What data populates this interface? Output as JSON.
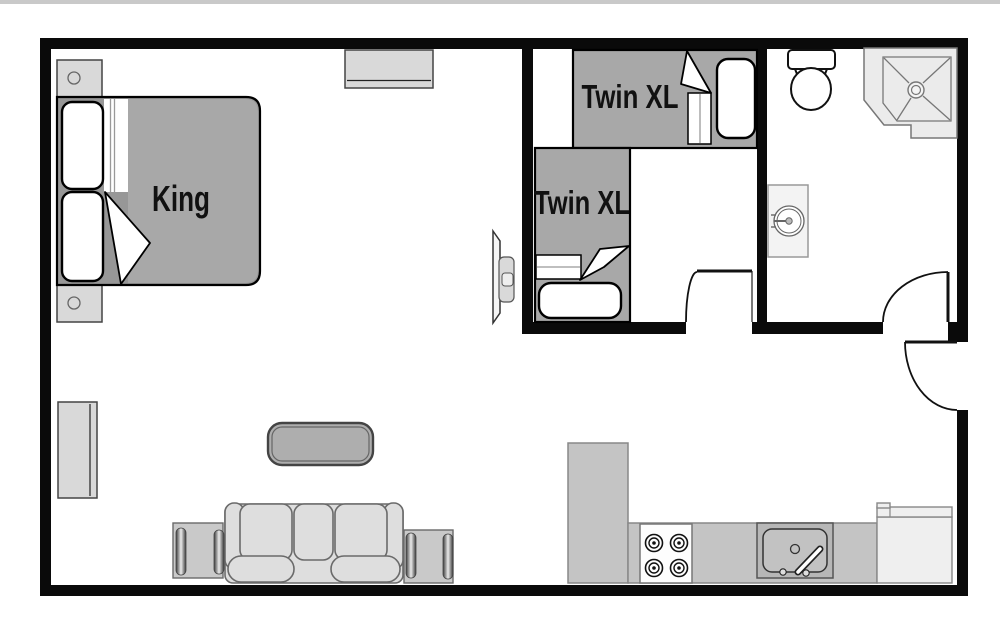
{
  "rooms": {
    "master": {
      "bed_label": "King"
    },
    "second": {
      "bed1_label": "Twin XL",
      "bed2_label": "Twin XL"
    }
  },
  "colors": {
    "floor": "#ffffff",
    "wall": "#0a0a0a",
    "top_strip": "#c9c9c9",
    "bed": "#a8a8a8",
    "bed_frame": "#979797",
    "light_furniture": "#d9d9d9",
    "sofa": "#dedede",
    "end_table": "#c9c9c9",
    "coffee_table": "#aeaeae",
    "counter": "#c4c4c4",
    "appliance": "#efefef",
    "shower": "#ebebeb",
    "vanity": "#f3f3f3",
    "label_text": "#111111"
  }
}
